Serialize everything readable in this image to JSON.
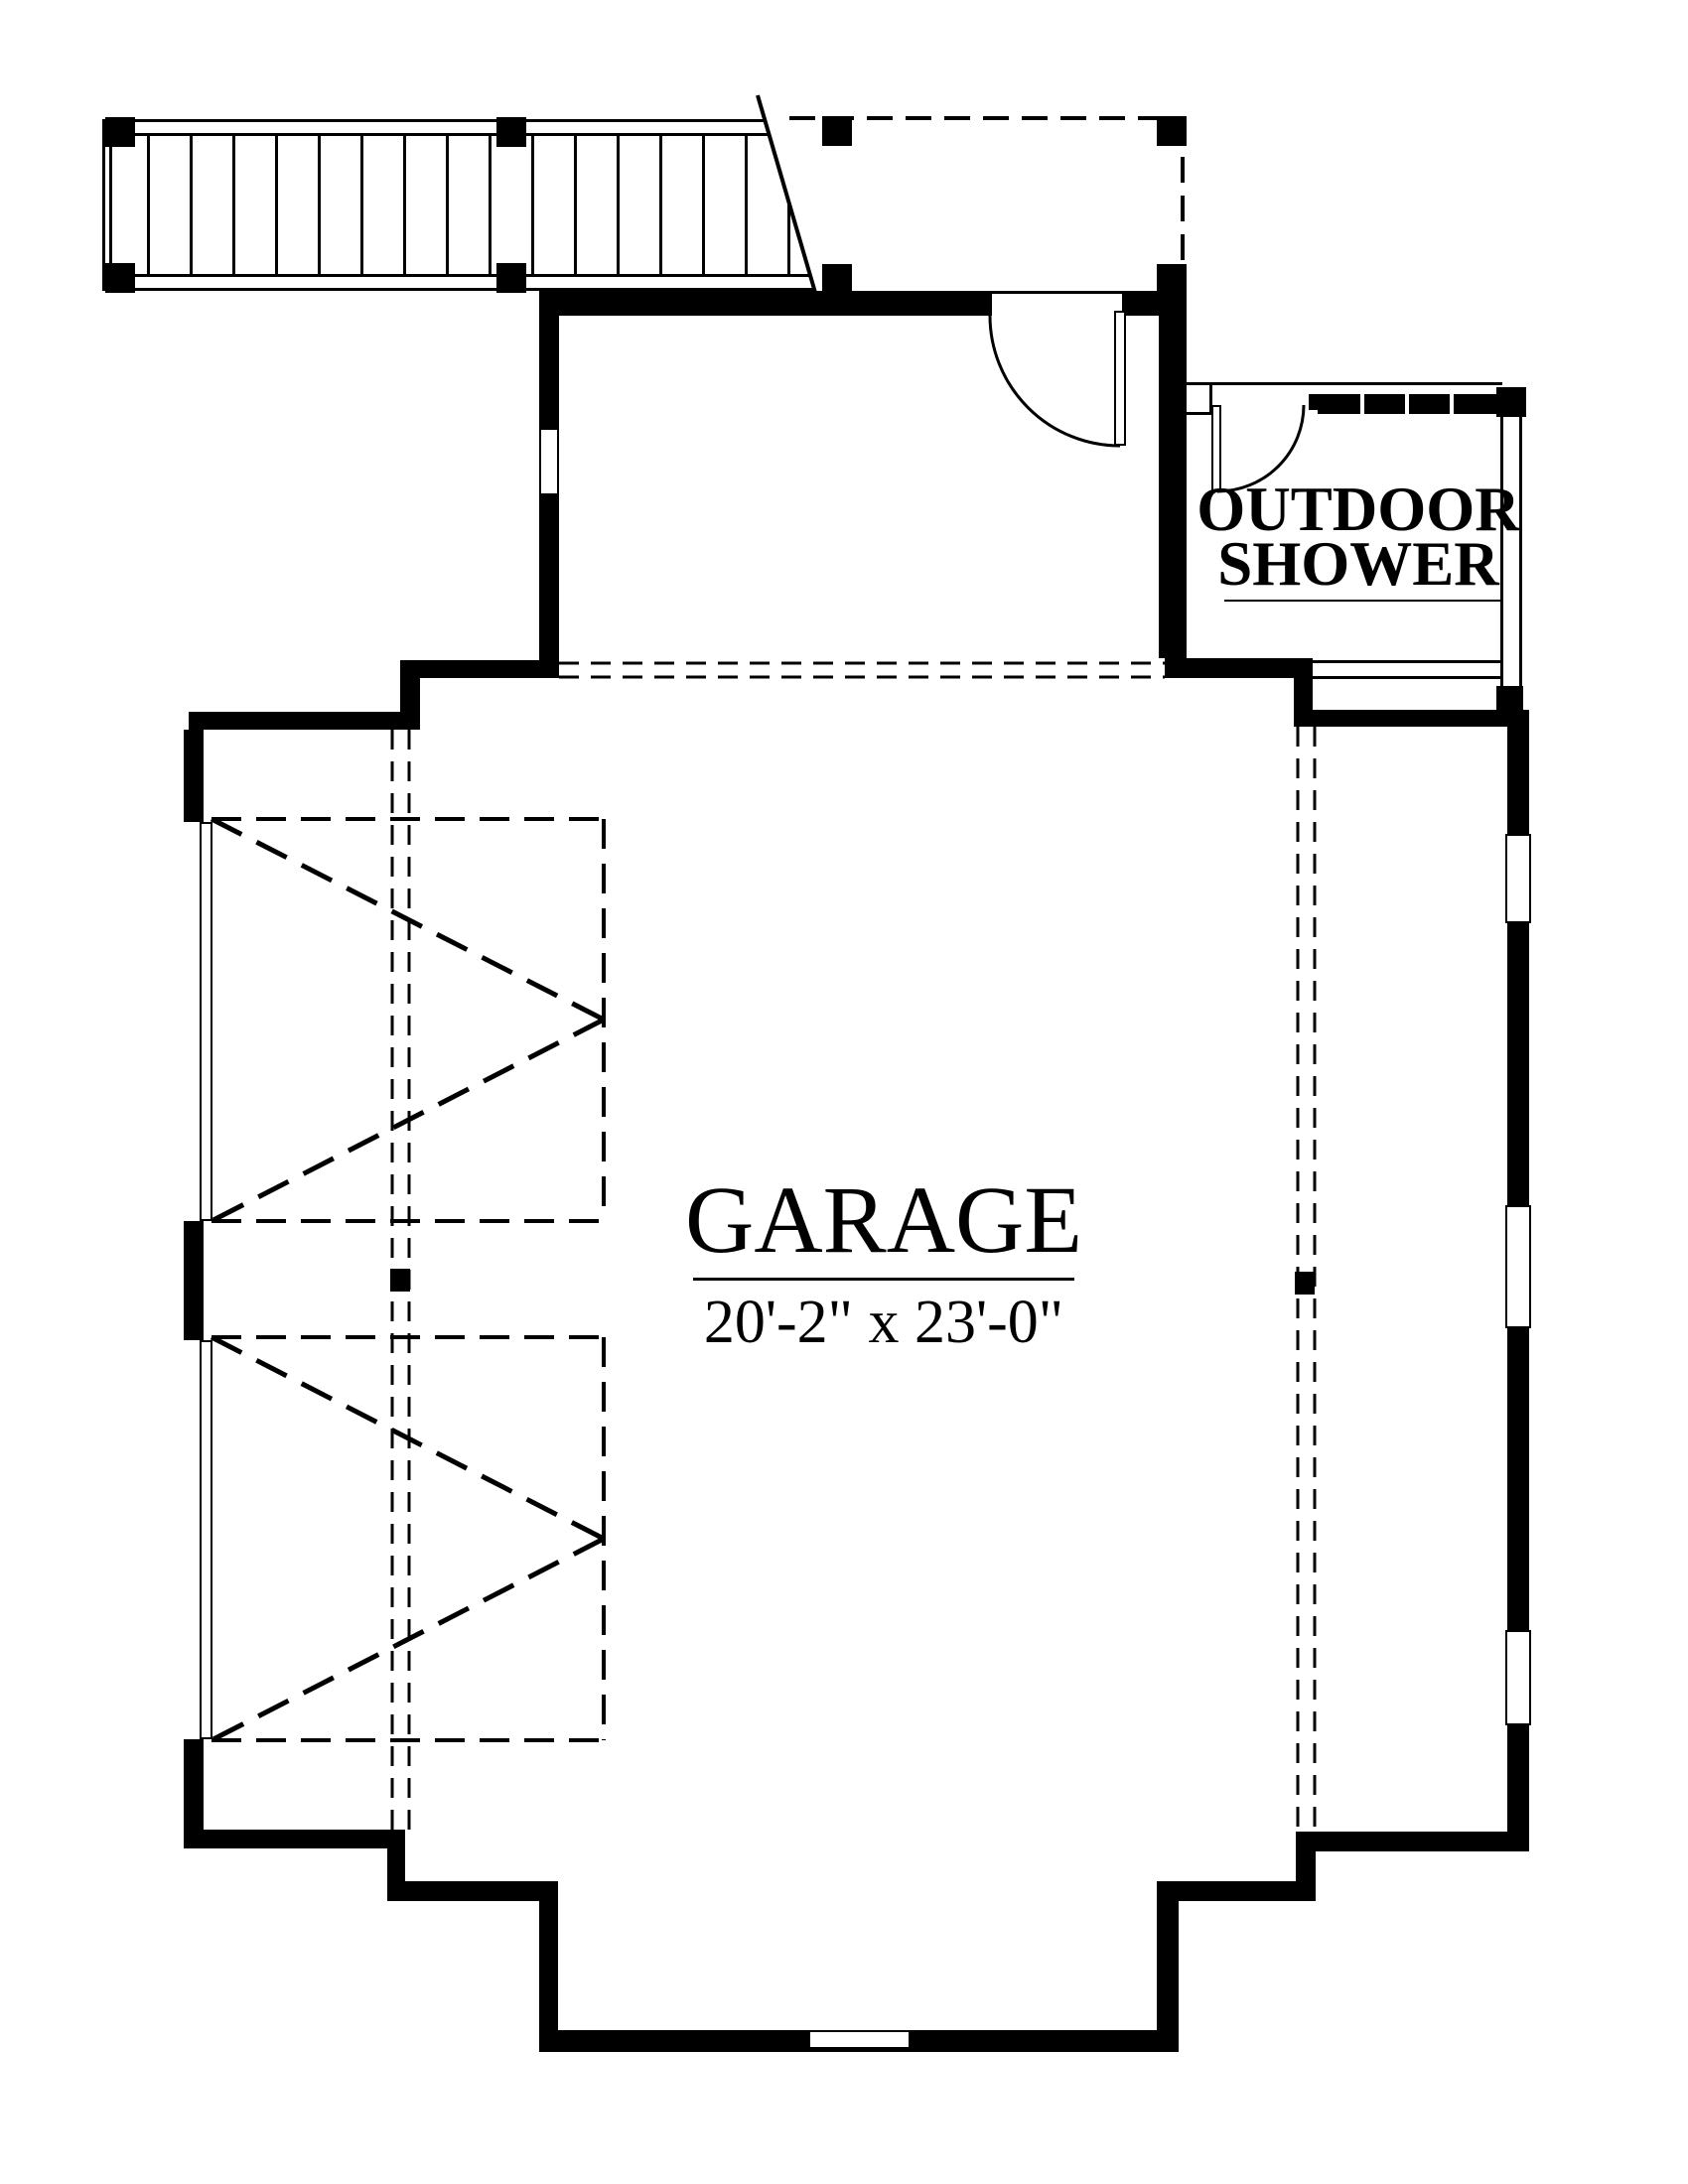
{
  "colors": {
    "ink": "#000000",
    "paper": "#ffffff"
  },
  "rooms": {
    "garage": {
      "label": "GARAGE",
      "dimensions": "20'-2\" x 23'-0\""
    },
    "outdoor_shower": {
      "line1": "OUTDOOR",
      "line2": "SHOWER"
    }
  }
}
